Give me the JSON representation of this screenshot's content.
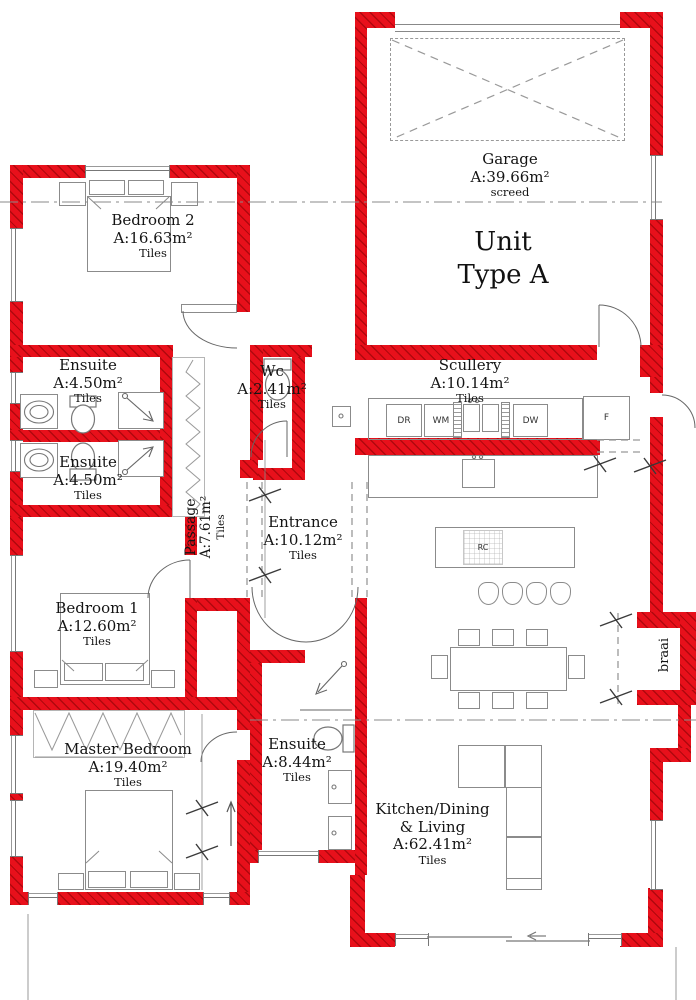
{
  "title": {
    "line1": "Unit",
    "line2": "Type A"
  },
  "rooms": {
    "bedroom2": {
      "name": "Bedroom 2",
      "area": "A:16.63m²",
      "floor": "Tiles"
    },
    "garage": {
      "name": "Garage",
      "area": "A:39.66m²",
      "floor": "screed"
    },
    "ensuite1": {
      "name": "Ensuite",
      "area": "A:4.50m²",
      "floor": "Tiles"
    },
    "ensuite2": {
      "name": "Ensuite",
      "area": "A:4.50m²",
      "floor": "Tiles"
    },
    "wc": {
      "name": "Wc",
      "area": "A:2.41m²",
      "floor": "Tiles"
    },
    "scullery": {
      "name": "Scullery",
      "area": "A:10.14m²",
      "floor": "Tiles"
    },
    "passage": {
      "name": "Passage",
      "area": "A:7.61m²",
      "floor": "Tiles"
    },
    "entrance": {
      "name": "Entrance",
      "area": "A:10.12m²",
      "floor": "Tiles"
    },
    "bedroom1": {
      "name": "Bedroom 1",
      "area": "A:12.60m²",
      "floor": "Tiles"
    },
    "master_bedroom": {
      "name": "Master Bedroom",
      "area": "A:19.40m²",
      "floor": "Tiles"
    },
    "ensuite3": {
      "name": "Ensuite",
      "area": "A:8.44m²",
      "floor": "Tiles"
    },
    "kitchen_living": {
      "name_line1": "Kitchen/Dining",
      "name_line2": "& Living",
      "area": "A:62.41m²",
      "floor": "Tiles"
    },
    "braai": {
      "name": "braai"
    }
  },
  "appliances": {
    "dr": "DR",
    "wm": "WM",
    "dw": "DW",
    "fridge": "F",
    "hob": "RC"
  },
  "colors": {
    "wall_red": "#e8101b",
    "line_gray": "#8b8b8b"
  }
}
